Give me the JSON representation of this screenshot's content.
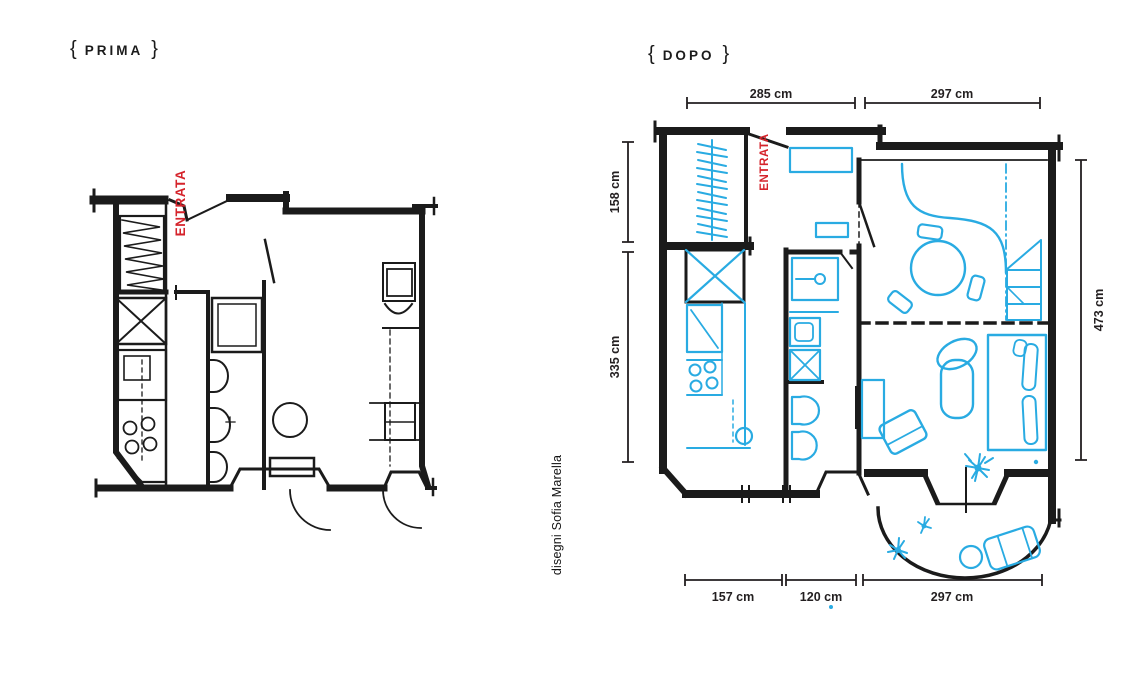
{
  "page": {
    "background": "#ffffff",
    "width": 1140,
    "height": 680
  },
  "colors": {
    "ink": "#1b1b1b",
    "furniture_blue": "#29abe2",
    "entrance_red": "#d5232b",
    "dimension_ink": "#231f20"
  },
  "headers": {
    "before": {
      "open_brace": "{",
      "label": "PRIMA",
      "close_brace": "}"
    },
    "after": {
      "open_brace": "{",
      "label": "DOPO",
      "close_brace": "}"
    }
  },
  "credit": "disegni Sofia Marella",
  "plans": {
    "before": {
      "entrance_label": "ENTRATA"
    },
    "after": {
      "entrance_label": "ENTRATA",
      "dimensions": {
        "top": [
          "285 cm",
          "297 cm"
        ],
        "left": [
          "158 cm",
          "335 cm"
        ],
        "right": [
          "473 cm"
        ],
        "bottom": [
          "157 cm",
          "120 cm",
          "297 cm"
        ]
      }
    }
  }
}
